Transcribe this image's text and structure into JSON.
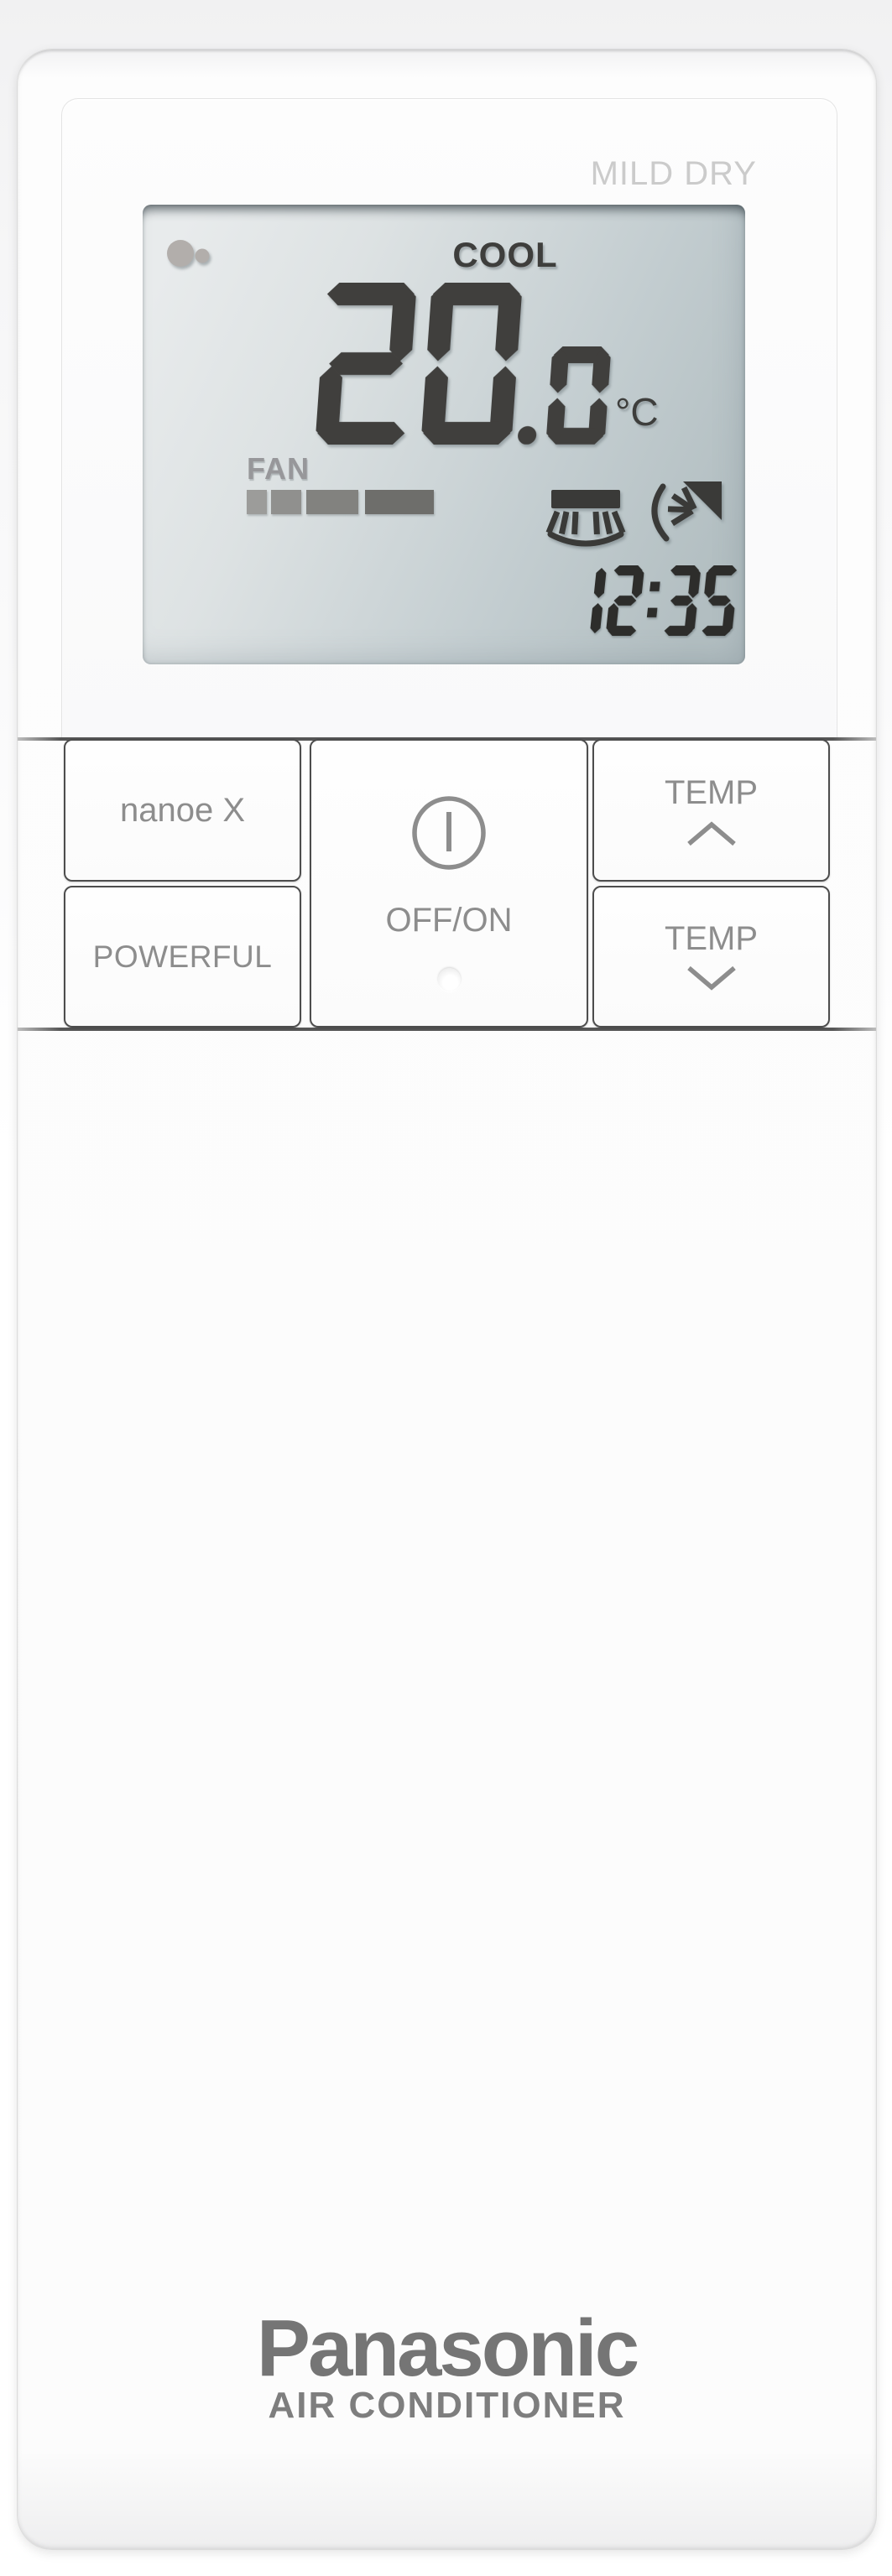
{
  "branding": {
    "logo": "Panasonic",
    "product_label": "AIR CONDITIONER"
  },
  "display": {
    "status_label": "MILD DRY",
    "mode": "COOL",
    "temperature": "20.0",
    "temp_main": "20",
    "temp_decimal": ".0",
    "temp_unit": "°C",
    "fan_label": "FAN",
    "fan_bars": [
      {
        "width": 24,
        "gap": 5,
        "color": "#9c9c9a"
      },
      {
        "width": 36,
        "gap": 6,
        "color": "#90908e"
      },
      {
        "width": 62,
        "gap": 8,
        "color": "#82827f"
      },
      {
        "width": 82,
        "gap": 0,
        "color": "#6e6e6b"
      }
    ],
    "time": "12:35",
    "icons": {
      "nanoe_indicator": "nanoe-indicator-icon",
      "vertical_swing": "airflow-vertical-swing-icon",
      "horizontal_swing": "airflow-horizontal-swing-icon"
    }
  },
  "buttons": {
    "nanoe_label": "nanoe X",
    "powerful_label": "POWERFUL",
    "power_label": "OFF/ON",
    "temp_up_label": "TEMP",
    "temp_down_label": "TEMP"
  },
  "colors": {
    "lcd_segment": "#403f3d",
    "clock_segment": "#2d2d2b",
    "lcd_icon": "#3a3a38",
    "nanoe_icon": "#b2aeab",
    "lcd_text": "#3e3e3c",
    "fan_text": "#97979a",
    "button_text": "#8d8d8d",
    "status_text": "#cbcbcb",
    "logo_text": "#757575",
    "product_text": "#7e7e7e",
    "panel_line": "#565656"
  }
}
